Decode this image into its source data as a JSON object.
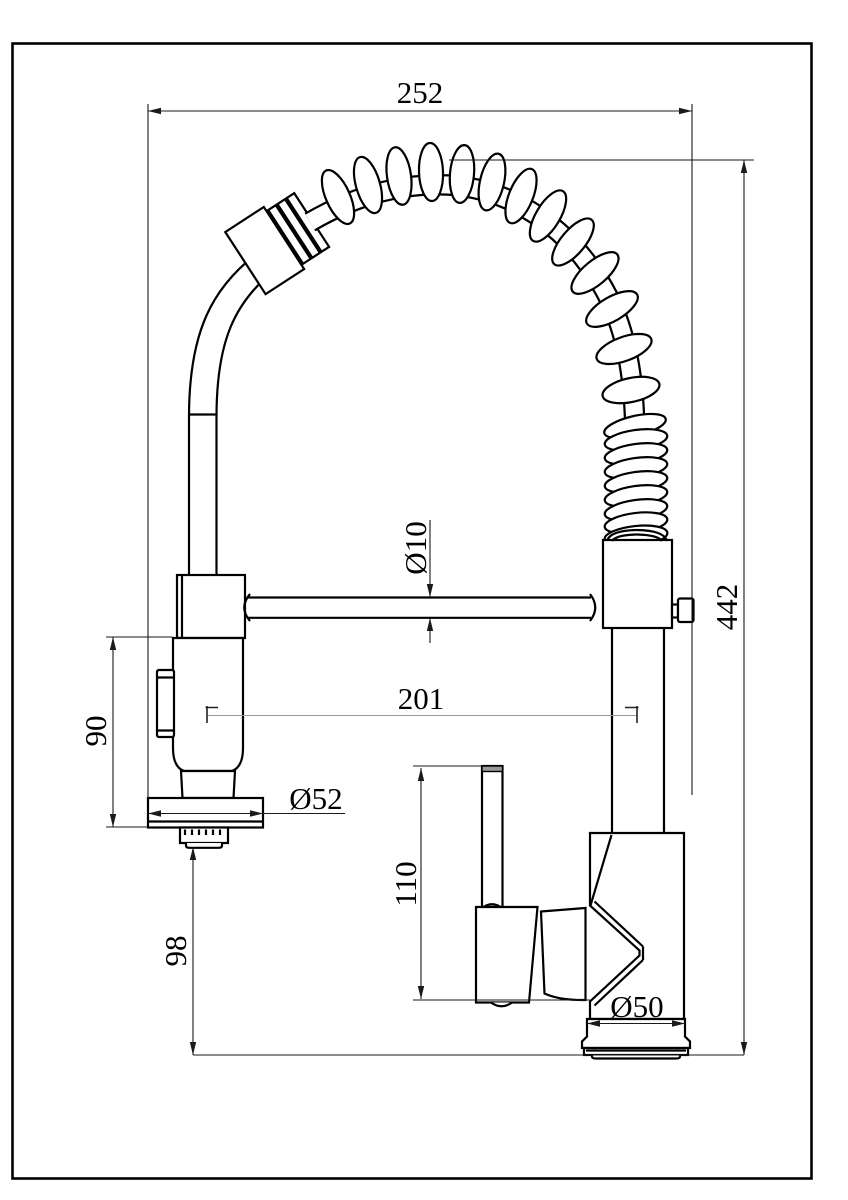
{
  "canvas": {
    "background": "#ffffff",
    "line_color": "#000000",
    "dimension_line_color": "#1a1a1a",
    "light_line_color": "#9a9a9a"
  },
  "labels": {
    "dim_top_width": "252",
    "dim_overall_height": "442",
    "dim_hose_diameter": "Ø10",
    "dim_center_distance": "201",
    "dim_sprayer_height": "90",
    "dim_sprayer_head_diameter": "Ø52",
    "dim_spout_clearance": "98",
    "dim_handle_height": "110",
    "dim_base_diameter": "Ø50"
  }
}
